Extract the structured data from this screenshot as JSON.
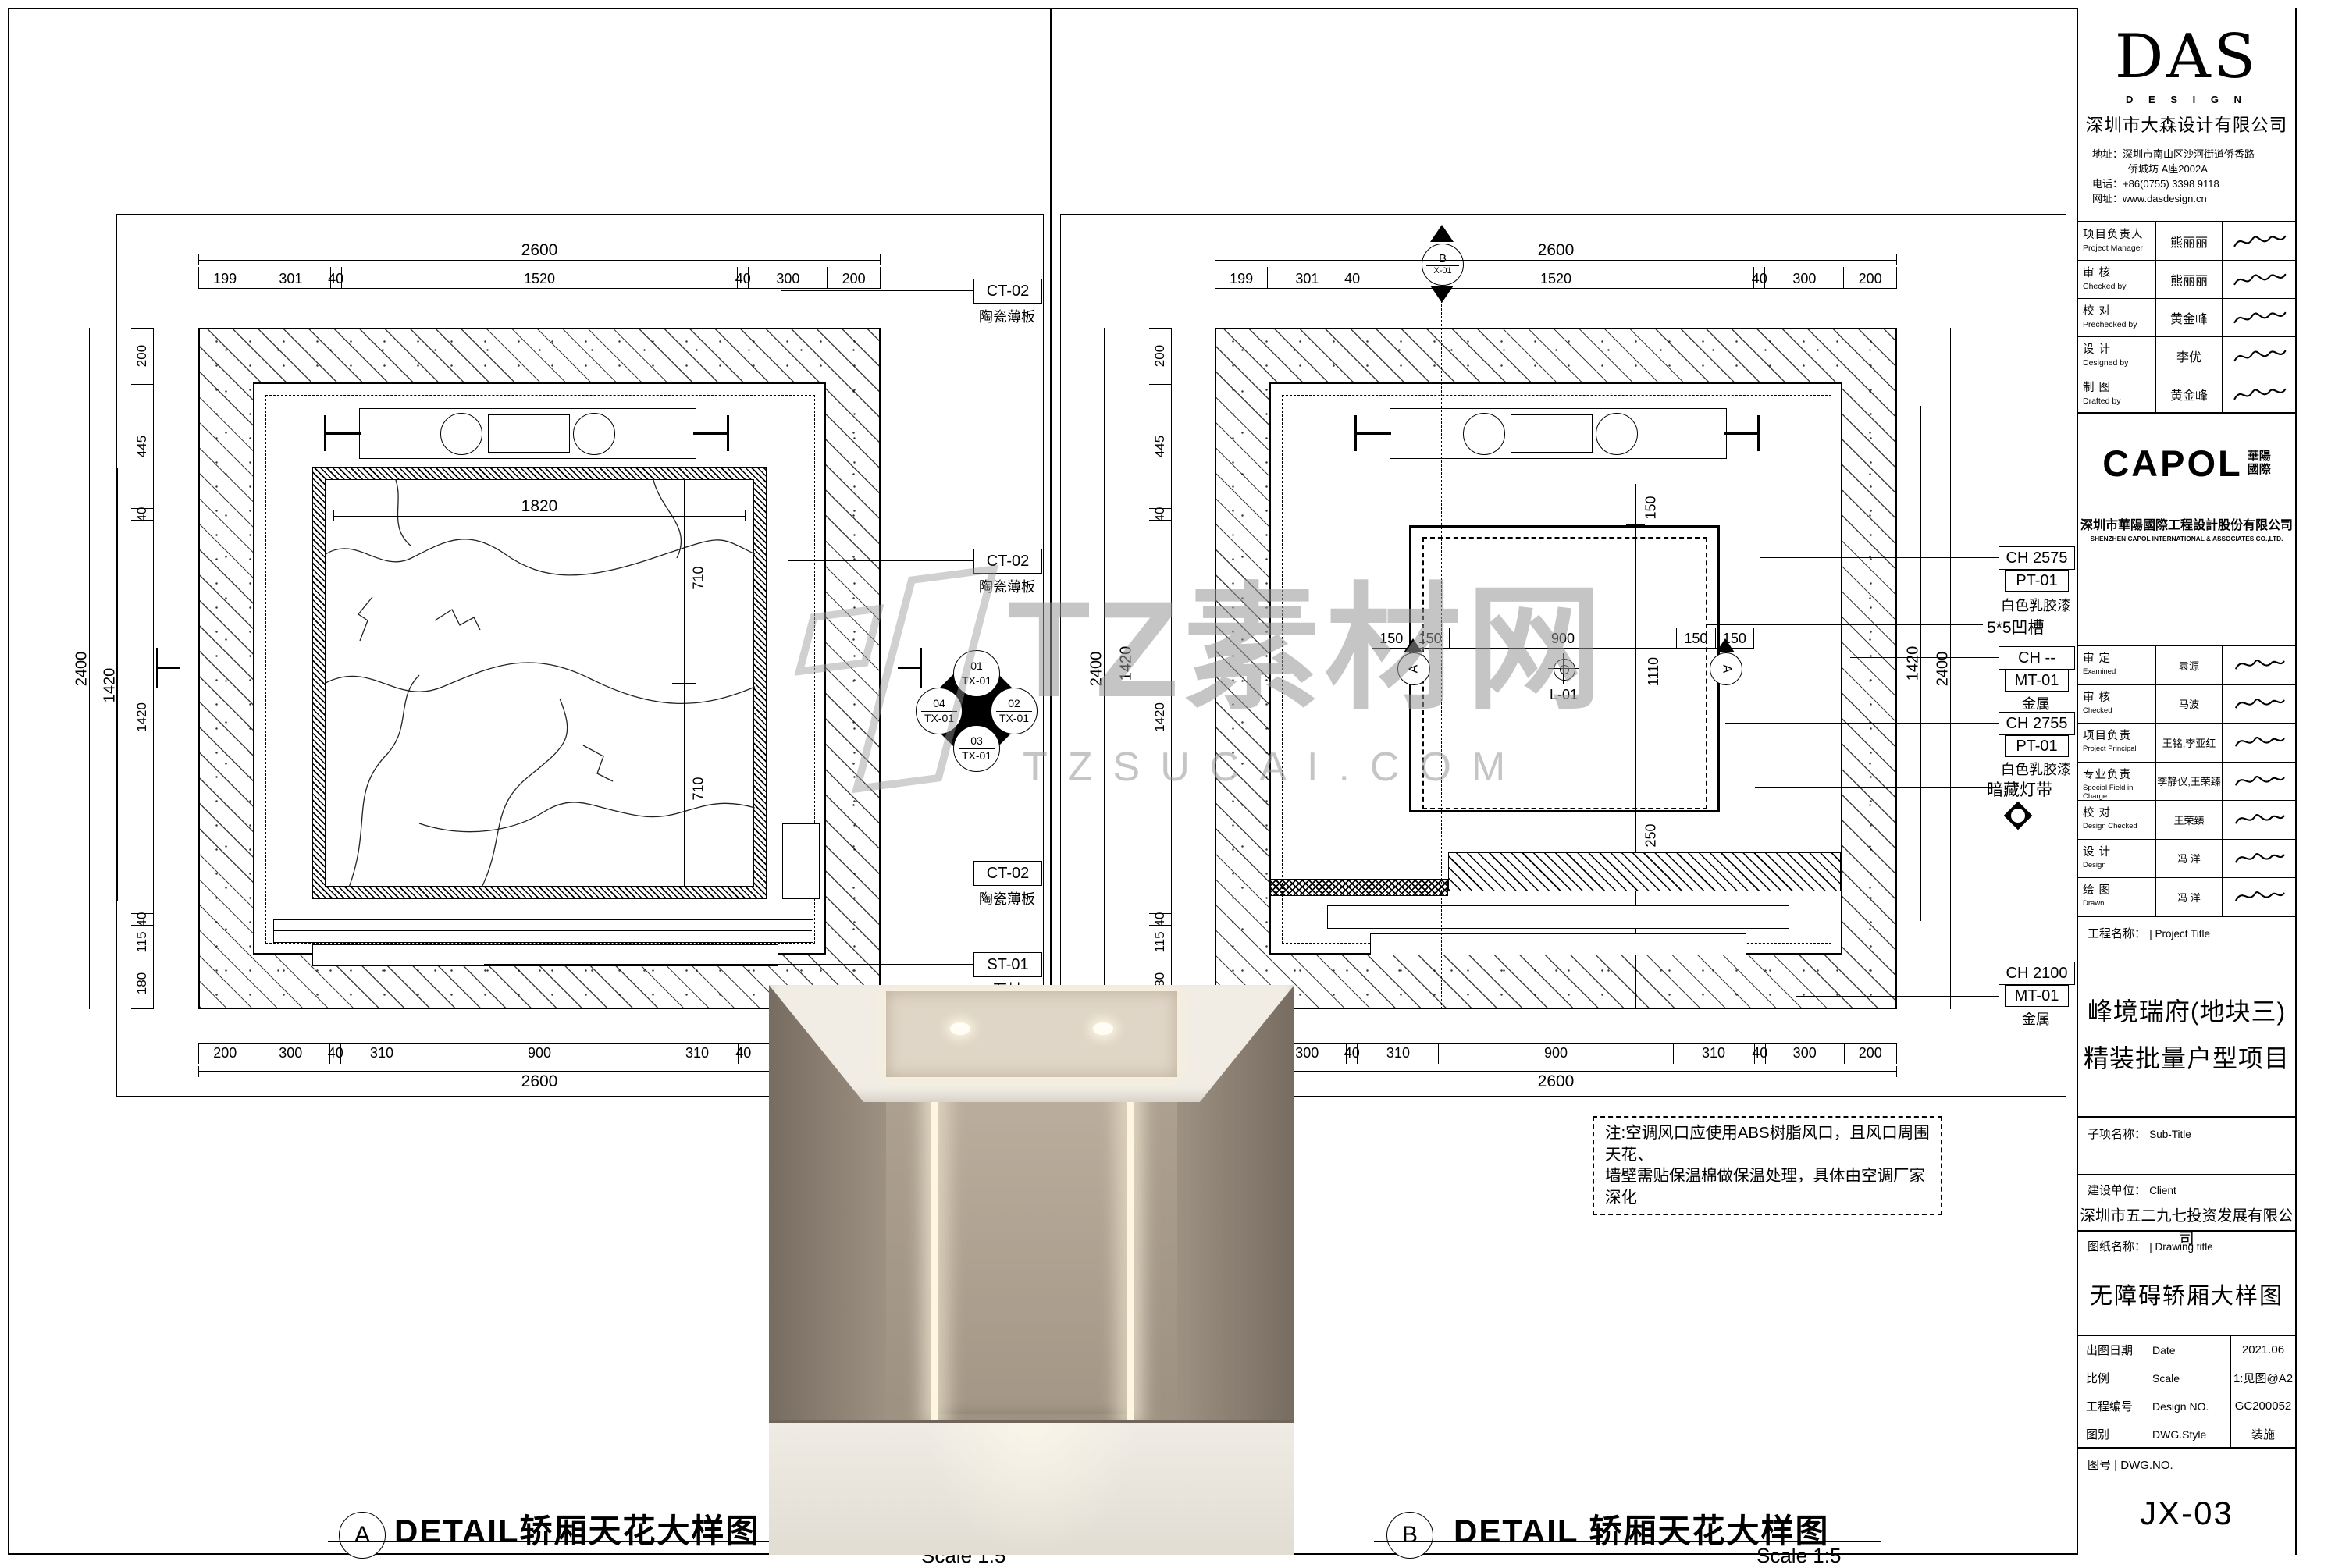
{
  "wm": {
    "l1": "TZ素材网",
    "l2": "TZSUCAI.COM"
  },
  "note": {
    "l1": "注:空调风口应使用ABS树脂风口，且风口周围天花、",
    "l2": "墙壁需贴保温棉做保温处理，具体由空调厂家深化"
  },
  "dims": {
    "overall_w": "2600",
    "overall_h": "2400",
    "inner_h": "1420",
    "top_chain": [
      {
        "t": "199",
        "f": 199
      },
      {
        "t": "301",
        "f": 301
      },
      {
        "t": "40",
        "f": 40
      },
      {
        "t": "1520",
        "f": 1520
      },
      {
        "t": "40",
        "f": 40
      },
      {
        "t": "300",
        "f": 300
      },
      {
        "t": "200",
        "f": 200
      }
    ],
    "bottom_chain": [
      {
        "t": "200",
        "f": 200
      },
      {
        "t": "300",
        "f": 300
      },
      {
        "t": "40",
        "f": 40
      },
      {
        "t": "310",
        "f": 310
      },
      {
        "t": "900",
        "f": 900
      },
      {
        "t": "310",
        "f": 310
      },
      {
        "t": "40",
        "f": 40
      },
      {
        "t": "300",
        "f": 300
      },
      {
        "t": "200",
        "f": 200
      }
    ],
    "left_chain": [
      {
        "t": "200",
        "f": 200
      },
      {
        "t": "445",
        "f": 445
      },
      {
        "t": "40",
        "f": 40
      },
      {
        "t": "1420",
        "f": 1420
      },
      {
        "t": "40",
        "f": 40
      },
      {
        "t": "115",
        "f": 115
      },
      {
        "t": "180",
        "f": 180
      }
    ]
  },
  "A": {
    "mark": "A",
    "title": "DETAIL轿厢天花大样图",
    "scale": "Scale 1:5",
    "panel_w": "1820",
    "panel_h1": "710",
    "panel_h2": "710",
    "tags": {
      "t1": {
        "code": "CT-02",
        "desc": "陶瓷薄板"
      },
      "t2": {
        "code": "CT-02",
        "desc": "陶瓷薄板"
      },
      "t3": {
        "code": "CT-02",
        "desc": "陶瓷薄板"
      },
      "t4": {
        "code": "ST-01",
        "desc": "石材"
      }
    },
    "finish": {
      "n1": "01",
      "c1": "TX-01",
      "n2": "02",
      "c2": "TX-01",
      "n3": "03",
      "c3": "TX-01",
      "n4": "04",
      "c4": "TX-01"
    }
  },
  "B": {
    "mark": "B",
    "title": "DETAIL 轿厢天花大样图",
    "scale": "Scale 1:5",
    "mid_chain": [
      {
        "t": "150",
        "f": 150
      },
      {
        "t": "150",
        "f": 150
      },
      {
        "t": "900",
        "f": 900
      },
      {
        "t": "150",
        "f": 150
      },
      {
        "t": "150",
        "f": 150
      }
    ],
    "dim_h": "1110",
    "dim_top": "150",
    "dim_bottom": "250",
    "center_label": "L-01",
    "sec_top": {
      "letter": "B",
      "ref": "X-01"
    },
    "sec_side": "A",
    "tags": {
      "m1": {
        "ch": "CH 2575",
        "code": "PT-01",
        "desc": "白色乳胶漆"
      },
      "m2": {
        "text": "5*5凹槽"
      },
      "m3": {
        "ch": "CH --",
        "code": "MT-01",
        "desc": "金属"
      },
      "m4": {
        "ch": "CH 2755",
        "code": "PT-01",
        "desc": "白色乳胶漆"
      },
      "m5": {
        "text": "暗藏灯带"
      },
      "m6": {
        "ch": "CH 2100",
        "code": "MT-01",
        "desc": "金属"
      }
    }
  },
  "tb": {
    "das": {
      "logo": "DAS",
      "sub": "D E S I G N",
      "company": "深圳市大森设计有限公司",
      "addr_label": "地址：",
      "addr1": "深圳市南山区沙河街道侨香路",
      "addr2": "侨城坊 A座2002A",
      "tel_label": "电话：",
      "tel": "+86(0755) 3398 9118",
      "web_label": "网址：",
      "web": "www.dasdesign.cn"
    },
    "sig1": [
      {
        "cn": "项目负责人",
        "en": "Project Manager",
        "name": "熊丽丽"
      },
      {
        "cn": "审    核",
        "en": "Checked by",
        "name": "熊丽丽"
      },
      {
        "cn": "校    对",
        "en": "Prechecked by",
        "name": "黄金峰"
      },
      {
        "cn": "设    计",
        "en": "Designed by",
        "name": "李优"
      },
      {
        "cn": "制    图",
        "en": "Drafted by",
        "name": "黄金峰"
      }
    ],
    "capol": {
      "logo": "CAPOL",
      "logo_cn1": "華陽",
      "logo_cn2": "國際",
      "company": "深圳市華陽國際工程設計股份有限公司",
      "company_en": "SHENZHEN CAPOL INTERNATIONAL & ASSOCIATES CO.,LTD."
    },
    "sig2": [
      {
        "cn": "审    定",
        "en": "Examined",
        "name": "袁源"
      },
      {
        "cn": "审    核",
        "en": "Checked",
        "name": "马波"
      },
      {
        "cn": "项目负责",
        "en": "Project Principal",
        "name": "王铭,李亚红"
      },
      {
        "cn": "专业负责",
        "en": "Special Field in Charge",
        "name": "李静仪,王荣臻"
      },
      {
        "cn": "校    对",
        "en": "Design Checked",
        "name": "王荣臻"
      },
      {
        "cn": "设    计",
        "en": "Design",
        "name": "冯 洋"
      },
      {
        "cn": "绘    图",
        "en": "Drawn",
        "name": "冯 洋"
      }
    ],
    "project": {
      "label_cn": "工程名称：",
      "label_en": "| Project Title",
      "line1": "峰境瑞府(地块三)",
      "line2": "精装批量户型项目"
    },
    "subtitle": {
      "label_cn": "子项名称：",
      "label_en": "Sub-Title"
    },
    "client": {
      "label_cn": "建设单位：",
      "label_en": "Client",
      "name": "深圳市五二九七投资发展有限公司"
    },
    "dwg_title": {
      "label_cn": "图纸名称：",
      "label_en": "| Drawing title",
      "name": "无障碍轿厢大样图"
    },
    "meta": [
      {
        "cn": "出图日期",
        "en": "Date",
        "val": "2021.06"
      },
      {
        "cn": "比例",
        "en": "Scale",
        "val": "1:见图@A2"
      },
      {
        "cn": "工程编号",
        "en": "Design NO.",
        "val": "GC200052"
      },
      {
        "cn": "图别",
        "en": "DWG.Style",
        "val": "装施"
      }
    ],
    "dwgno": {
      "label": "图号 | DWG.NO.",
      "value": "JX-03"
    }
  }
}
